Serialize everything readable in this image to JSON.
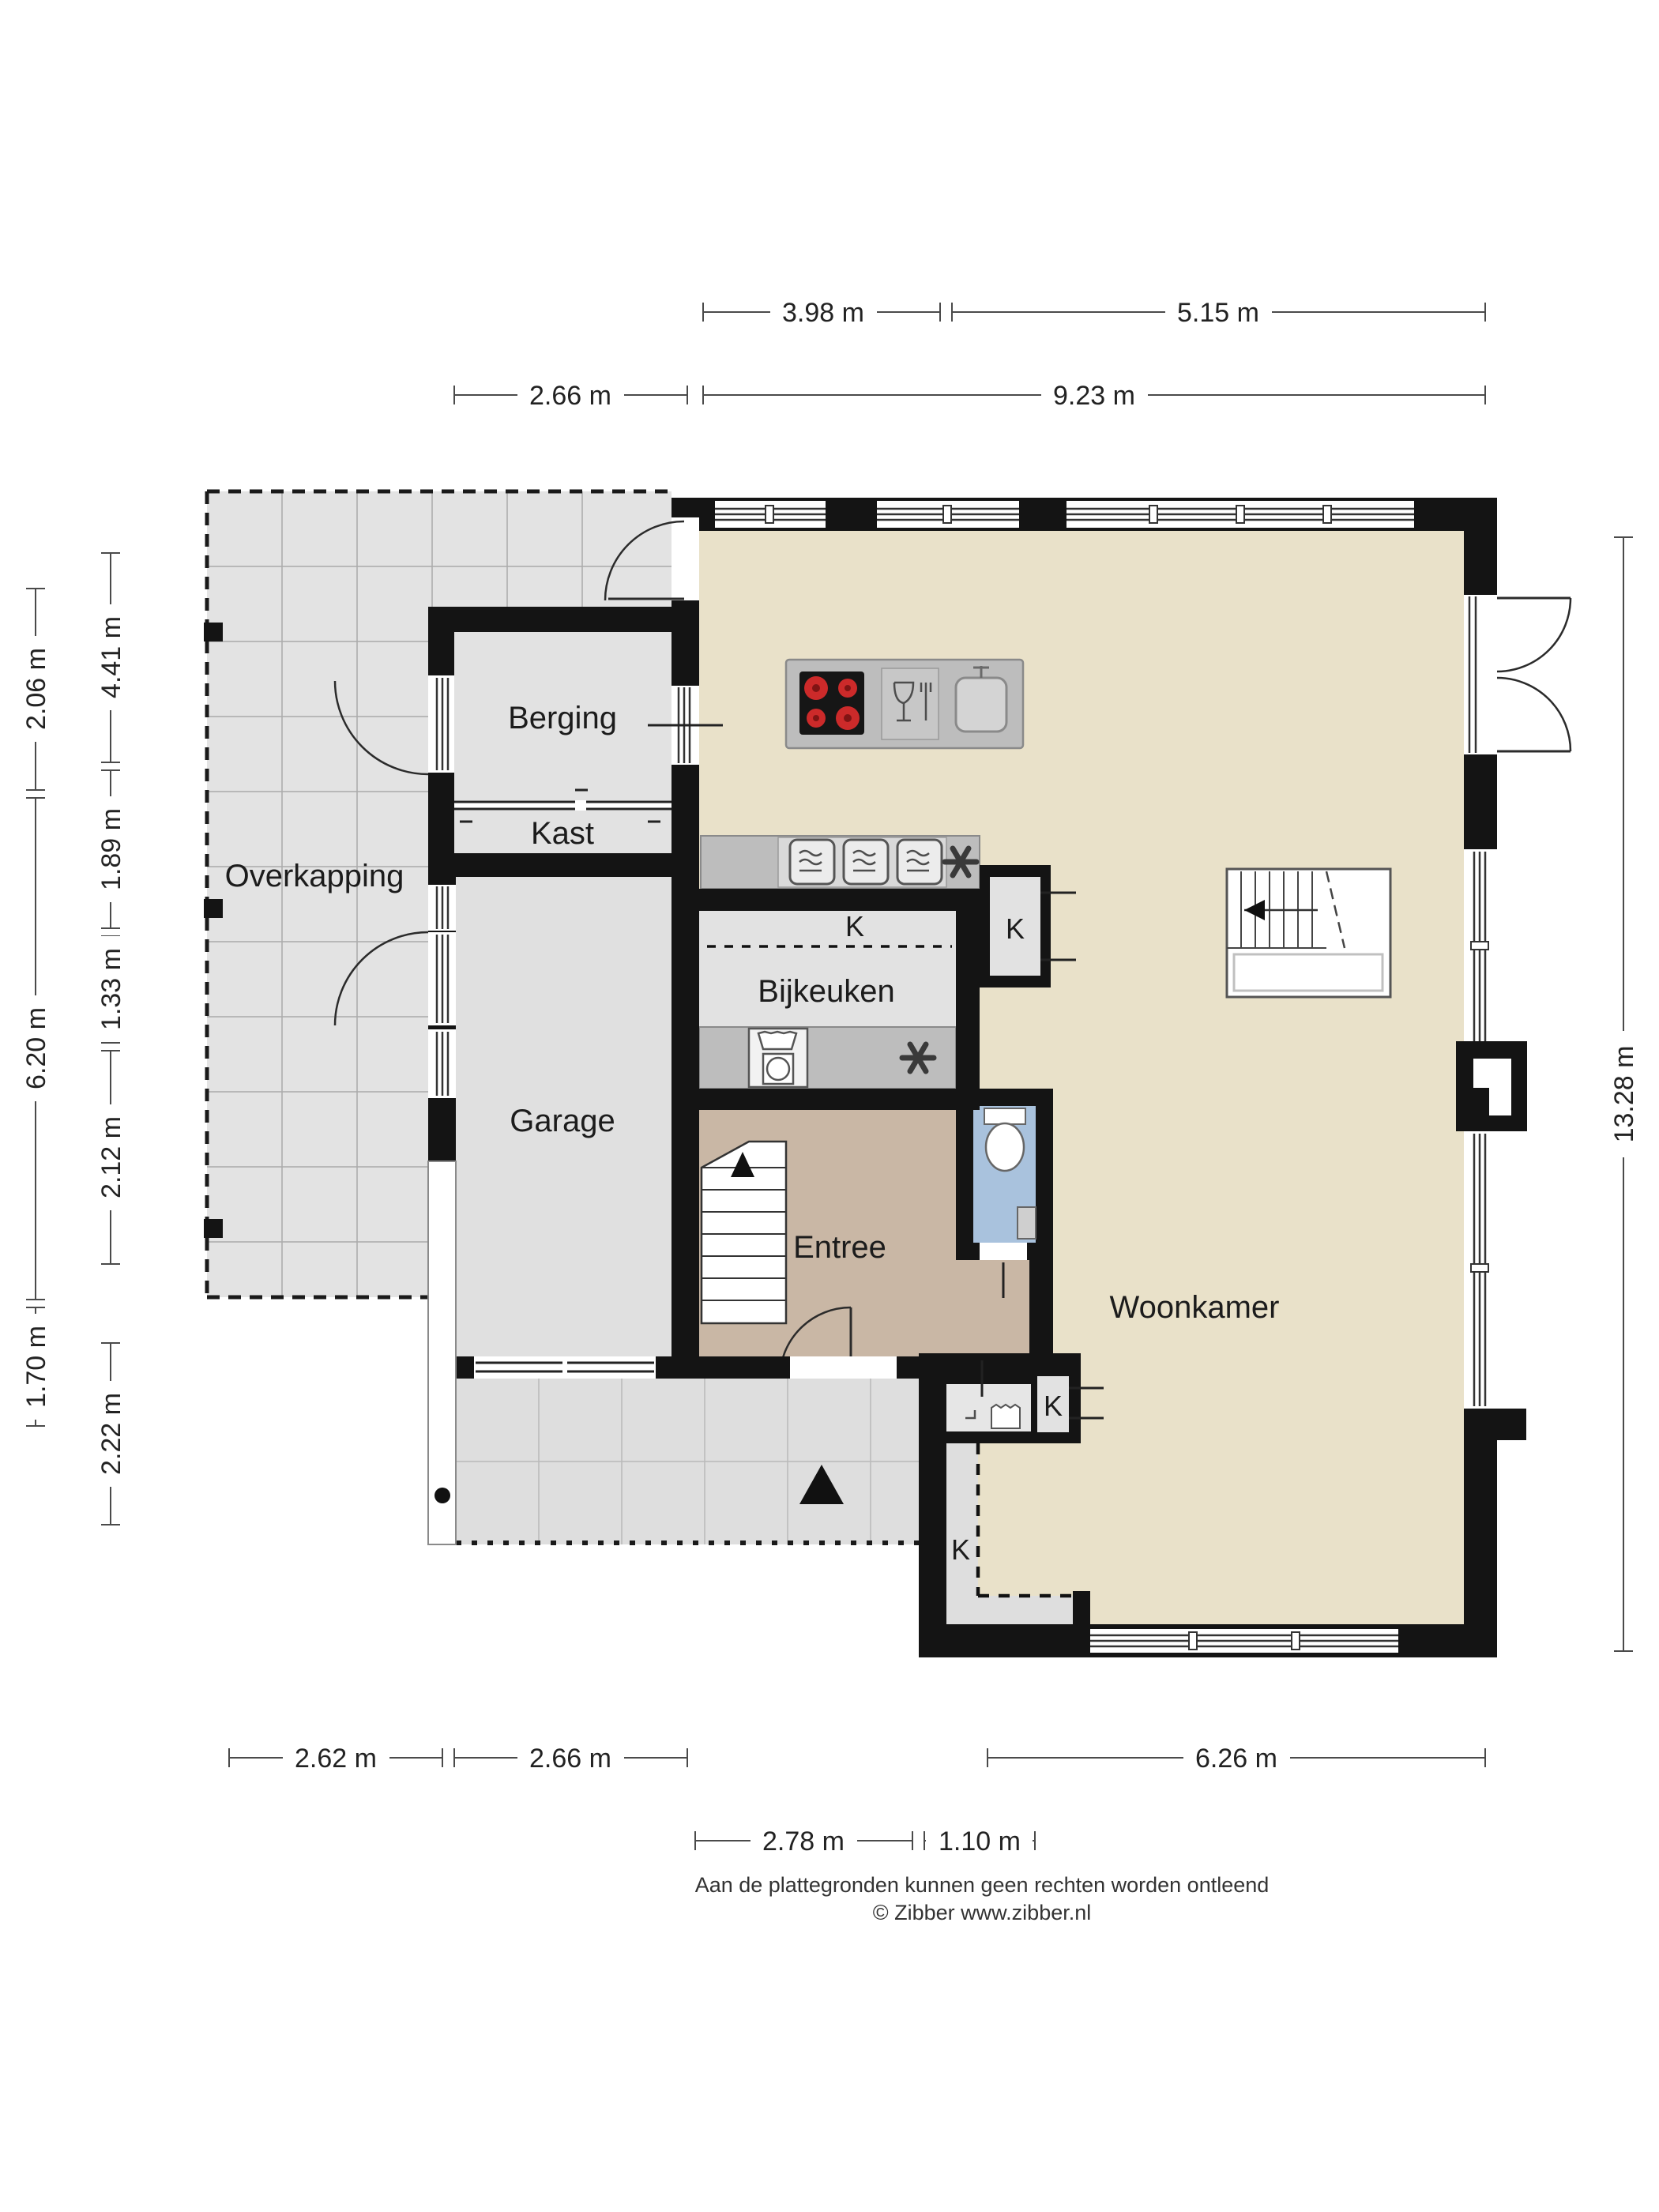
{
  "rooms": {
    "overkapping": "Overkapping",
    "berging": "Berging",
    "kast": "Kast",
    "garage": "Garage",
    "bijkeuken": "Bijkeuken",
    "entree": "Entree",
    "woonkamer": "Woonkamer"
  },
  "closet_labels": {
    "kitchen": "K",
    "bijkeuken": "K",
    "hall": "K",
    "pantry": "K"
  },
  "dimensions": {
    "top_row1": [
      "3.98 m",
      "5.15 m"
    ],
    "top_row2": [
      "2.66 m",
      "9.23 m"
    ],
    "left_outer": [
      "2.06 m",
      "6.20 m",
      "1.70 m"
    ],
    "left_inner": [
      "4.41 m",
      "1.89 m",
      "1.33 m",
      "2.12 m",
      "2.22 m"
    ],
    "right": [
      "13.28 m"
    ],
    "bottom_row1": [
      "2.62 m",
      "2.66 m",
      "6.26 m"
    ],
    "bottom_row2": [
      "2.78 m",
      "1.10 m"
    ]
  },
  "footer": {
    "disclaimer": "Aan de plattegronden kunnen geen rechten worden ontleend",
    "credit": "© Zibber www.zibber.nl"
  },
  "icons": [
    "cooktop-icon",
    "dishwasher-icon",
    "sink-icon",
    "oven-icon",
    "extractor-fan-icon",
    "washing-machine-icon",
    "laundry-basket-icon",
    "toilet-icon",
    "hand-basin-icon",
    "stairs-up-icon",
    "entrance-arrow-icon",
    "post-icon"
  ],
  "colors": {
    "wall": "#141414",
    "living_floor": "#e9e1c9",
    "utility_floor": "#e2e2e2",
    "entry_floor": "#c9b7a5",
    "toilet_floor": "#a9c2dd",
    "counter": "#bdbdbd",
    "tile_line": "#adadad",
    "burner_red": "#cc2a2a",
    "dimension_line": "#4a4a4a"
  }
}
